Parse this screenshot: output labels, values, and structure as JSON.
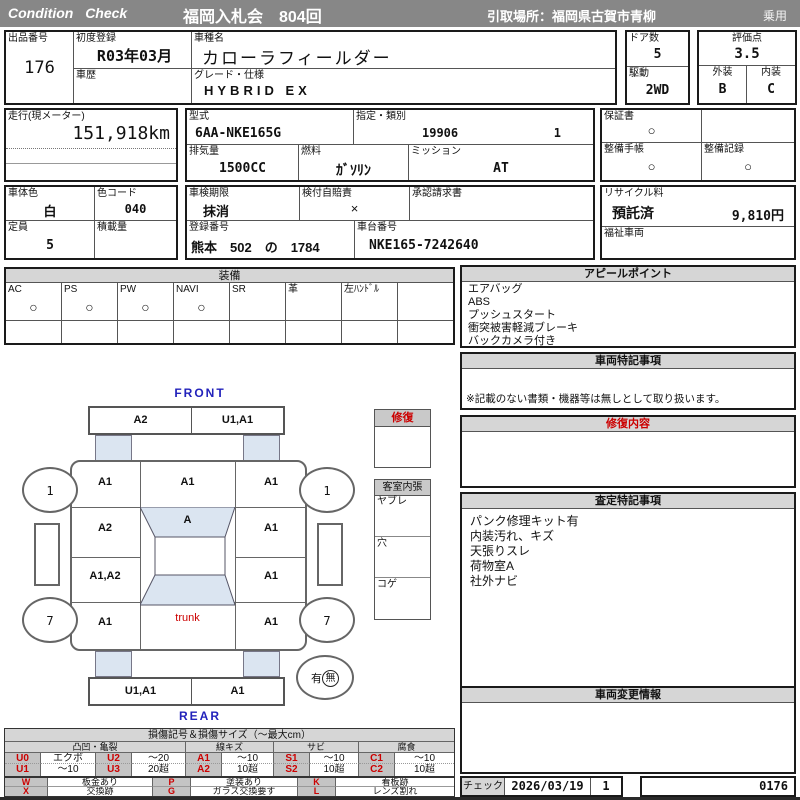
{
  "header": {
    "brand": "Condition Check",
    "auction_title": "福岡入札会　804回",
    "pickup_location": "引取場所：福岡県古賀市青柳",
    "vehicle_class": "乗用"
  },
  "vehicle": {
    "lot_label": "出品番号",
    "lot_number": "176",
    "first_reg_label": "初度登録",
    "first_reg": "R03年03月",
    "history_label": "車歴",
    "model_label": "車種名",
    "model_name": "カローラフィールダー",
    "grade_label": "グレード・仕様",
    "grade": "HYBRID EX",
    "doors_label": "ドア数",
    "doors": "5",
    "drive_label": "駆動",
    "drive": "2WD",
    "score_label": "評価点",
    "score": "3.5",
    "exterior_label": "外装",
    "exterior": "B",
    "interior_label": "内装",
    "interior": "C"
  },
  "spec": {
    "mileage_label": "走行(現メーター)",
    "mileage": "151,918km",
    "model_code_label": "型式",
    "model_code": "6AA-NKE165G",
    "class_label": "指定・類別",
    "class_no": "19906",
    "class_sub": "1",
    "displacement_label": "排気量",
    "displacement": "1500CC",
    "fuel_label": "燃料",
    "fuel": "ｶﾞｿﾘﾝ",
    "mission_label": "ミッション",
    "mission": "AT",
    "warranty_label": "保証書",
    "warranty": "○",
    "maint_book_label": "整備手帳",
    "maint_book": "○",
    "maint_record_label": "整備記録",
    "maint_record": "○"
  },
  "registration": {
    "body_color_label": "車体色",
    "body_color": "白",
    "color_code_label": "色コード",
    "color_code": "040",
    "inspection_label": "車検期限",
    "inspection": "抹消",
    "jibaiseki_label": "検付自賠責",
    "jibaiseki": "×",
    "approval_label": "承認請求書",
    "recycle_label": "リサイクル料",
    "recycle_status": "預託済",
    "recycle_fee": "9,810円",
    "capacity_label": "定員",
    "capacity": "5",
    "load_label": "積載量",
    "reg_no_label": "登録番号",
    "reg_no": "熊本　502　の　1784",
    "chassis_label": "車台番号",
    "chassis_no": "NKE165-7242640",
    "welfare_label": "福祉車両"
  },
  "equipment": {
    "title": "装備",
    "items": [
      {
        "label": "AC",
        "mark": "○"
      },
      {
        "label": "PS",
        "mark": "○"
      },
      {
        "label": "PW",
        "mark": "○"
      },
      {
        "label": "NAVI",
        "mark": "○"
      },
      {
        "label": "SR",
        "mark": ""
      },
      {
        "label": "革",
        "mark": ""
      },
      {
        "label": "左ﾊﾝﾄﾞﾙ",
        "mark": ""
      },
      {
        "label": "",
        "mark": ""
      }
    ]
  },
  "diagram": {
    "front_label": "FRONT",
    "rear_label": "REAR",
    "front_bumper_left": "A2",
    "front_bumper_right": "U1,A1",
    "left_front_fender": "A1",
    "hood": "A1",
    "right_front_fender": "A1",
    "left_front_door": "A2",
    "windshield": "A",
    "right_front_door": "A1",
    "left_rear_door": "A1,A2",
    "right_rear_door": "A1",
    "left_rear_fender": "A1",
    "trunk": "trunk",
    "right_rear_fender": "A1",
    "rear_bumper_left": "U1,A1",
    "rear_bumper_right": "A1",
    "wheel_front_left": "1",
    "wheel_front_right": "1",
    "wheel_rear_left": "7",
    "wheel_rear_right": "7",
    "spare_yes": "有",
    "spare_no": "無",
    "repair_box_title": "修復",
    "cabin_title": "客室内張",
    "cabin_rows": [
      "ヤブレ",
      "穴",
      "コゲ"
    ]
  },
  "panels": {
    "appeal_title": "アピールポイント",
    "appeal_items": [
      "エアバッグ",
      "ABS",
      "プッシュスタート",
      "衝突被害軽減ブレーキ",
      "バックカメラ付き"
    ],
    "notes_title": "車両特記事項",
    "notes_footer": "※記載のない書類・機器等は無しとして取り扱います。",
    "repair_title": "修復内容",
    "assessment_title": "査定特記事項",
    "assessment_items": [
      "パンク修理キット有",
      "内装汚れ、キズ",
      "天張りスレ",
      "荷物室A",
      "社外ナビ"
    ],
    "change_title": "車両変更情報"
  },
  "check": {
    "label": "チェック",
    "date": "2026/03/19",
    "count": "1",
    "serial": "0176"
  },
  "legend": {
    "title": "損傷記号＆損傷サイズ（～最大cm）",
    "groups": [
      "凸凹・亀裂",
      "線キズ",
      "サビ",
      "腐食"
    ],
    "row1": [
      "U0",
      "エクボ",
      "U2",
      "～20",
      "A1",
      "～10",
      "S1",
      "～10",
      "C1",
      "～10"
    ],
    "row2": [
      "U1",
      "～10",
      "U3",
      "20超",
      "A2",
      "10超",
      "S2",
      "10超",
      "C2",
      "10超"
    ],
    "row3": [
      "W",
      "板金あり",
      "P",
      "塗装あり",
      "K",
      "看板跡"
    ],
    "row4": [
      "X",
      "交換跡",
      "G",
      "ガラス交換要す",
      "L",
      "レンズ割れ"
    ]
  }
}
